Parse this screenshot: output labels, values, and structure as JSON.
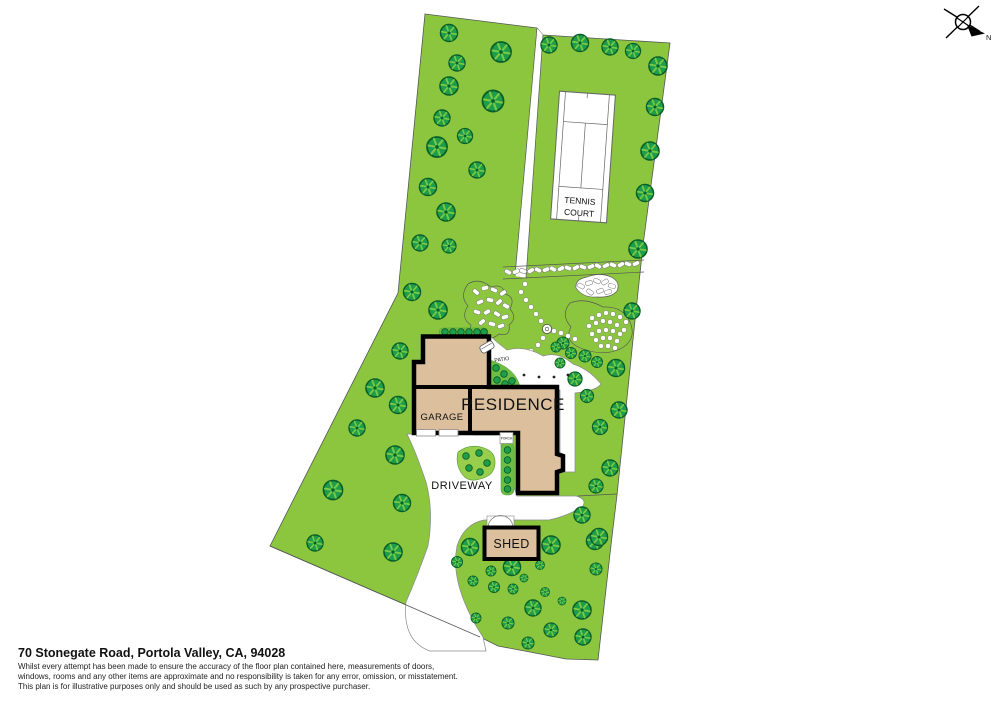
{
  "footer": {
    "title": "70 Stonegate Road, Portola Valley, CA, 94028",
    "disclaimer_lines": [
      "Whilst every attempt has been made to ensure the accuracy of the floor plan contained here, measurements of doors,",
      "windows, rooms and any other items are approximate and no responsibility is taken for any error, omission, or misstatement.",
      "This plan is for illustrative purposes only and should be used as such by any prospective purchaser."
    ]
  },
  "plan": {
    "labels": {
      "residence": "RESIDENCE",
      "garage": "GARAGE",
      "driveway": "DRIVEWAY",
      "shed": "SHED",
      "patio": "PATIO",
      "porch": "PORCH",
      "tennis_line1": "TENNIS",
      "tennis_line2": "COURT"
    },
    "compass": {
      "north_label": "N"
    },
    "colors": {
      "lawn": "#8CC63F",
      "tree_fill": "#1E9E4A",
      "tree_outline": "#0A5F29",
      "building_fill": "#DCC09E",
      "building_outline": "#000000",
      "shrub_bed": "#6EBE45",
      "driveway_island": "#97CE4B",
      "path_outline": "#8A8A8A",
      "boundary_line": "#555555",
      "court_line": "#666666"
    }
  }
}
